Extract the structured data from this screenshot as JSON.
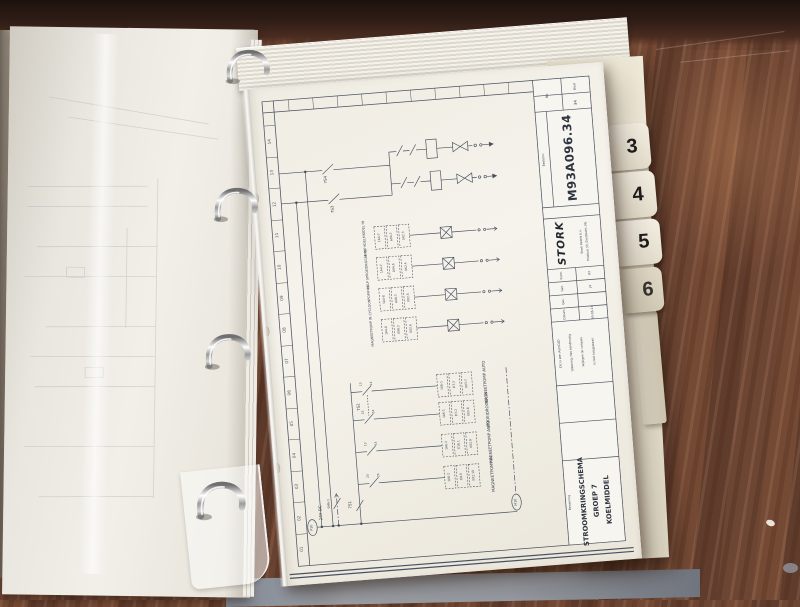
{
  "binder": {
    "tabs": [
      "3",
      "4",
      "5",
      "6"
    ]
  },
  "title_block": {
    "sheet_label": "Blad",
    "sheet_value": "34",
    "no_label": "No.",
    "order_label": "Bestelnr.",
    "doc_number": "M93A096.34",
    "company": "STORK",
    "company_reg": "®",
    "company_line1": "Stork Ketels b.v.",
    "company_line2": "Postbus 33, Dordrecht, NL",
    "form_rows": [
      {
        "label": "Form.",
        "value": "A3"
      },
      {
        "label": "Get.",
        "value": "JV"
      },
      {
        "label": "Gec.",
        "value": ""
      },
      {
        "label": "Datum",
        "value": "93-06-14"
      }
    ],
    "note_lines": [
      "Dit is een AutoCAD",
      "tekening. Het handmatig",
      "wijzigen op calques",
      "is niet toegestaan."
    ],
    "name_label": "Benaming",
    "drawing_title": [
      "STROOMKRINGSCHEMA",
      "GROEP 7",
      "KOELMIDDEL"
    ]
  },
  "schematic": {
    "grid_numbers": [
      "14",
      "13",
      "12",
      "11",
      "10",
      "09",
      "08",
      "07",
      "06",
      "05",
      "04",
      "03",
      "02",
      "01"
    ],
    "switches": {
      "s4": "7S4",
      "s3": "7S3",
      "s2": "7S2",
      "s1": "7S1",
      "m6": "6M6-1"
    },
    "contacts": {
      "c13": "13",
      "c14": "14",
      "c23": "23",
      "c24": "24"
    },
    "supply": {
      "left_tag": "P10",
      "voltage": "24V DC",
      "right_tag": "M10"
    },
    "upper_circuits": [
      {
        "name": "4.KLP KOELMIDDEL IN",
        "io": [
          "1A4-7",
          "A04.7",
          "0X2.3"
        ]
      },
      {
        "name": "4.KLP SPROEIDROGER IN",
        "io": [
          "1A4-7",
          "A04.6",
          "0X2.4"
        ]
      },
      {
        "name": "CYCLOONPOMP IN",
        "io": [
          "1A4-8",
          "A08.3",
          "0X2.5"
        ]
      },
      {
        "name": "MAGNEETPOMP IN",
        "io": [
          "1A4-8",
          "A08.2",
          "0X2.6"
        ]
      }
    ],
    "lower_circuits": [
      {
        "name": "MAGNEETPOMP AUTO",
        "io": [
          "1A6-1",
          "D7.3",
          "0X3.7"
        ]
      },
      {
        "name": "SPROEIDROGER IN",
        "io": [
          "1A6-1",
          "D7.2",
          "0X3.8"
        ]
      },
      {
        "name": "MAGNEETPOMP AUTO",
        "io": [
          "1A6-2",
          "E18.1",
          "0X2.9"
        ]
      },
      {
        "name": "MAGNEETPOMP IN",
        "io": [
          "1A6-2",
          "E8.0",
          "0X2.10"
        ]
      }
    ]
  }
}
